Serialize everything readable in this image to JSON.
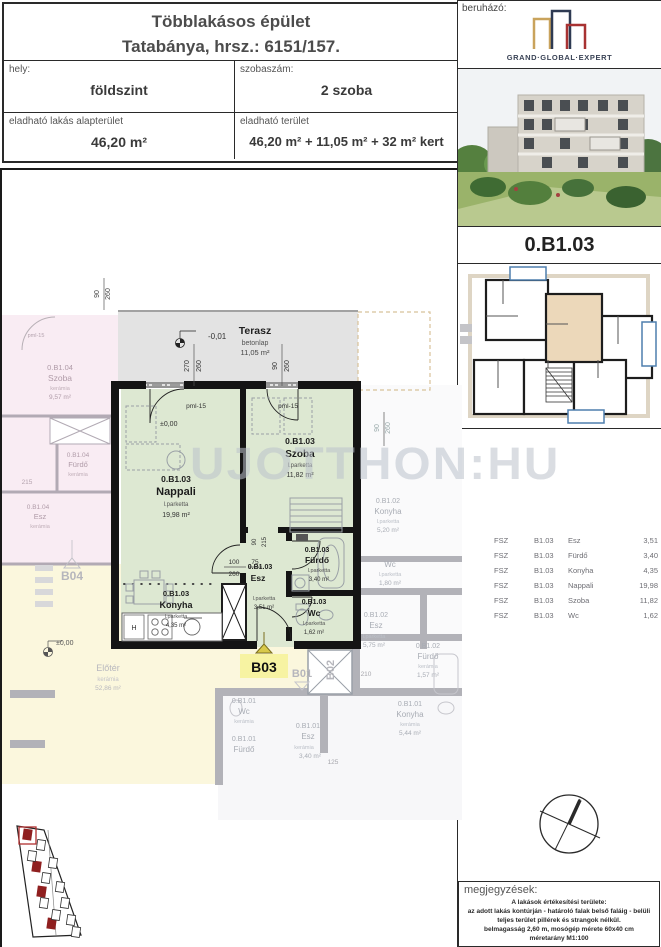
{
  "header": {
    "title_line1": "Többlakásos épület",
    "title_line2": "Tatabánya, hrsz.: 6151/157.",
    "hely_label": "hely:",
    "hely_value": "földszint",
    "szobaszam_label": "szobaszám:",
    "szobaszam_value": "2 szoba",
    "alapterulet_label": "eladható lakás alapterület",
    "alapterulet_value": "46,20 m²",
    "terulet_label": "eladható terület",
    "terulet_value": "46,20 m² + 11,05 m² + 32 m² kert"
  },
  "developer": {
    "label": "beruházó:",
    "brand": "GRAND·GLOBAL·EXPERT"
  },
  "unit_code": "0.B1.03",
  "room_table": {
    "rows": [
      {
        "floor": "FSZ",
        "unit": "B1.03",
        "room": "Esz",
        "area": "3,51"
      },
      {
        "floor": "FSZ",
        "unit": "B1.03",
        "room": "Fürdő",
        "area": "3,40"
      },
      {
        "floor": "FSZ",
        "unit": "B1.03",
        "room": "Konyha",
        "area": "4,35"
      },
      {
        "floor": "FSZ",
        "unit": "B1.03",
        "room": "Nappali",
        "area": "19,98"
      },
      {
        "floor": "FSZ",
        "unit": "B1.03",
        "room": "Szoba",
        "area": "11,82"
      },
      {
        "floor": "FSZ",
        "unit": "B1.03",
        "room": "Wc",
        "area": "1,62"
      }
    ]
  },
  "notes": {
    "label": "megjegyzések:",
    "lines": [
      "A lakások értékesítési területe:",
      "az adott lakás kontúrján - határoló falak belső faláig - belüli",
      "teljes terület pillérek és strangok nélkül.",
      "belmagasság  2,60 m, mosógép mérete 60x40 cm",
      "méretarány M1:100"
    ]
  },
  "plan": {
    "watermark": "UJOTTHON:HU",
    "terasz": {
      "name": "Terasz",
      "material": "betonlap",
      "area": "11,05 m²"
    },
    "rooms": {
      "nappali": {
        "code": "0.B1.03",
        "name": "Nappali",
        "material": "l.parketta",
        "area": "19,98 m²"
      },
      "szoba": {
        "code": "0.B1.03",
        "name": "Szoba",
        "material": "l.parketta",
        "area": "11,82 m²"
      },
      "furdo": {
        "code": "0.B1.03",
        "name": "Fürdő",
        "material": "l.parketta",
        "area": "3,40 m²"
      },
      "wc": {
        "code": "0.B1.03",
        "name": "Wc",
        "material": "l.parketta",
        "area": "1,62 m²"
      },
      "esz": {
        "code": "0.B1.03",
        "name": "Esz",
        "material": "l.parketta",
        "area": "3,51 m²"
      },
      "konyha": {
        "code": "0.B1.03",
        "name": "Konyha",
        "material": "l.parketta",
        "area": "4,35 m²"
      }
    },
    "levels": {
      "terrace": "-0,01",
      "ground": "±0,00"
    },
    "door_label": "pml-15",
    "fridge_label": "H",
    "markers": {
      "b03": "B03",
      "b01": "B01",
      "b02": "B02",
      "b04": "B04"
    },
    "dims": {
      "d270": "270",
      "d260": "260",
      "d90": "90",
      "d100": "100",
      "d75": "75",
      "d215": "215",
      "d125": "125",
      "d210": "210"
    },
    "neighbors": {
      "b104_szoba": {
        "code": "0.B1.04",
        "name": "Szoba",
        "material": "kerámia",
        "area": "9,57 m²"
      },
      "b104_furdo": {
        "code": "0.B1.04",
        "name": "Fürdő",
        "material": "kerámia"
      },
      "b104_esz": {
        "code": "0.B1.04",
        "name": "Esz",
        "material": "kerámia"
      },
      "eloter": {
        "name": "Előtér",
        "material": "kerámia",
        "area": "52,86 m²"
      },
      "b102_konyha": {
        "code": "0.B1.02",
        "name": "Konyha",
        "material": "l.parketta",
        "area": "5,20 m²"
      },
      "b102_wc": {
        "name": "Wc",
        "material": "l.parketta",
        "area": "1,80 m²"
      },
      "b102_esz": {
        "code": "0.B1.02",
        "name": "Esz",
        "material": "l.parketta",
        "area": "5,75 m²"
      },
      "b102_furdo": {
        "code": "0.B1.02",
        "name": "Fürdő",
        "material": "kerámia",
        "area": "1,57 m²"
      },
      "b101_wc": {
        "code": "0.B1.01",
        "name": "Wc",
        "material": "kerámia"
      },
      "b101_esz": {
        "code": "0.B1.01",
        "name": "Esz",
        "material": "kerámia",
        "area": "3,40 m²"
      },
      "b101_furdo": {
        "code": "0.B1.01",
        "name": "Fürdő"
      },
      "b101_konyha": {
        "code": "0.B1.01",
        "name": "Konyha",
        "material": "kerámia",
        "area": "5,44 m²"
      }
    }
  }
}
